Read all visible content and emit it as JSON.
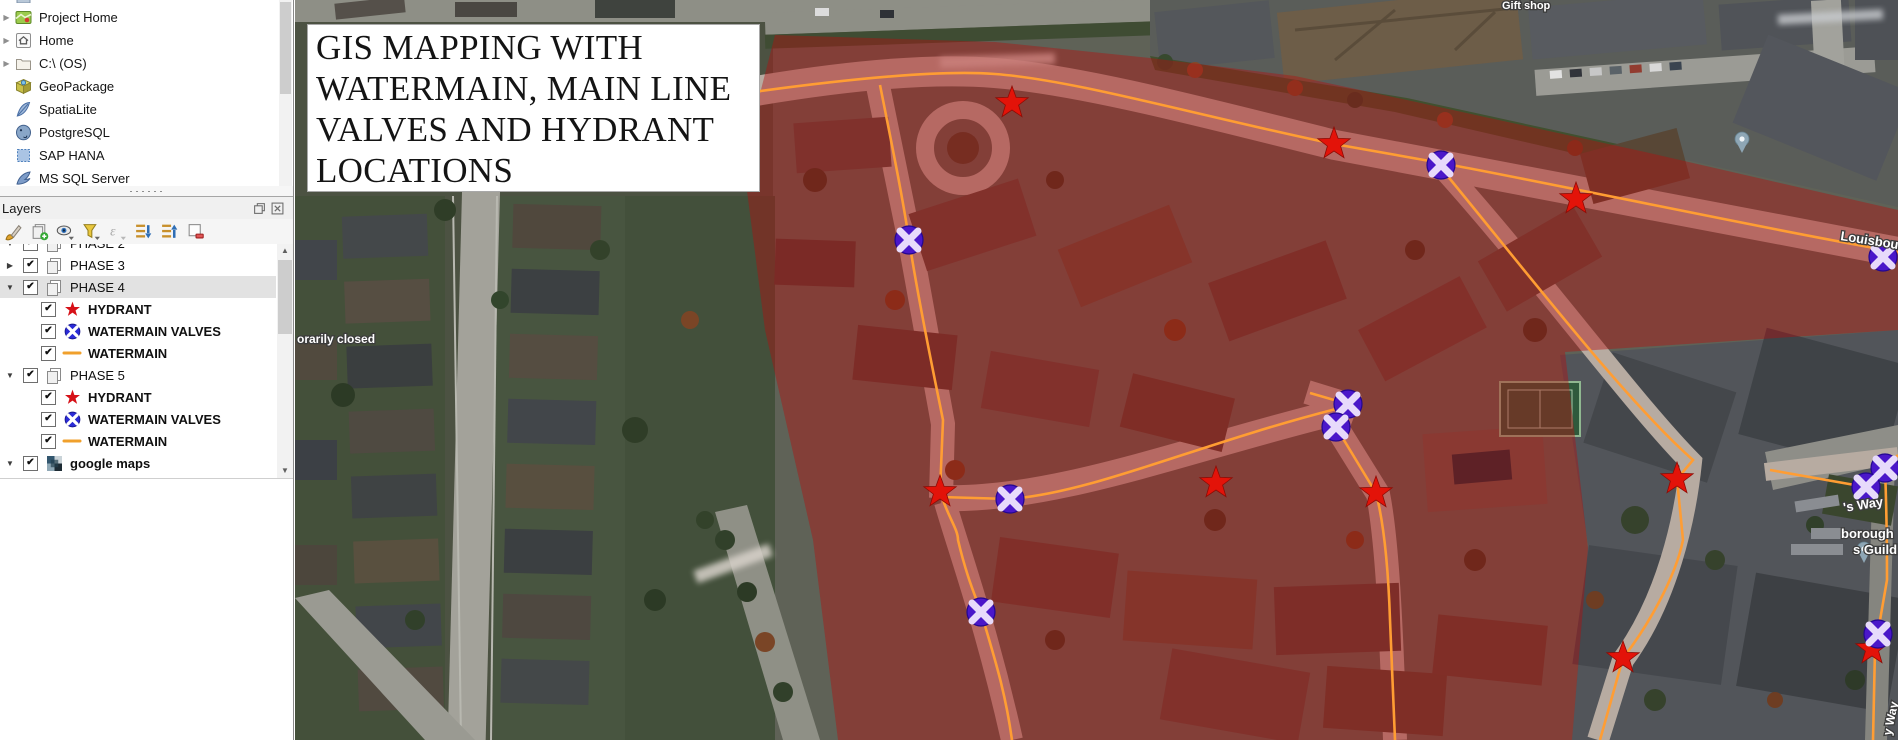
{
  "browser_panel": {
    "items": [
      {
        "label": "",
        "icon": "clipped-item",
        "partial": "top",
        "expand": false
      },
      {
        "label": "Project Home",
        "icon": "project-home",
        "expand": true
      },
      {
        "label": "Home",
        "icon": "home",
        "expand": true
      },
      {
        "label": "C:\\ (OS)",
        "icon": "drive-folder",
        "expand": true
      },
      {
        "label": "GeoPackage",
        "icon": "geopackage",
        "expand": false
      },
      {
        "label": "SpatiaLite",
        "icon": "spatialite",
        "expand": false
      },
      {
        "label": "PostgreSQL",
        "icon": "postgresql",
        "expand": false
      },
      {
        "label": "SAP HANA",
        "icon": "sap-hana",
        "expand": false
      },
      {
        "label": "MS SQL Server",
        "icon": "ms-sql-server",
        "expand": false
      },
      {
        "label": "",
        "icon": "clipped-item-bottom",
        "partial": "bottom",
        "expand": false
      }
    ]
  },
  "layers_panel": {
    "title": "Layers",
    "window_buttons": [
      {
        "name": "float-panel"
      },
      {
        "name": "close-panel"
      }
    ],
    "toolbar": [
      {
        "name": "open-layer-styling"
      },
      {
        "name": "add-group"
      },
      {
        "name": "manage-map-themes"
      },
      {
        "name": "filter-legend"
      },
      {
        "name": "filter-by-expression"
      },
      {
        "name": "expand-all"
      },
      {
        "name": "collapse-all"
      },
      {
        "name": "remove-layer"
      }
    ],
    "tree": [
      {
        "label": "PHASE 2",
        "kind": "group",
        "checked": true,
        "expander": "open",
        "partial": "top"
      },
      {
        "label": "PHASE 3",
        "kind": "group",
        "checked": true,
        "expander": "closed"
      },
      {
        "label": "PHASE 4",
        "kind": "group",
        "checked": true,
        "expander": "open",
        "selected": true
      },
      {
        "label": "HYDRANT",
        "kind": "layer",
        "symbol": "hydrant-star",
        "checked": true
      },
      {
        "label": "WATERMAIN VALVES",
        "kind": "layer",
        "symbol": "watermain-valve",
        "checked": true
      },
      {
        "label": "WATERMAIN",
        "kind": "layer",
        "symbol": "watermain-line",
        "checked": true
      },
      {
        "label": "PHASE 5",
        "kind": "group",
        "checked": true,
        "expander": "open"
      },
      {
        "label": "HYDRANT",
        "kind": "layer",
        "symbol": "hydrant-star",
        "checked": true
      },
      {
        "label": "WATERMAIN VALVES",
        "kind": "layer",
        "symbol": "watermain-valve",
        "checked": true
      },
      {
        "label": "WATERMAIN",
        "kind": "layer",
        "symbol": "watermain-line",
        "checked": true
      },
      {
        "label": "google maps",
        "kind": "basemap",
        "symbol": "basemap-tiles",
        "checked": true,
        "expander": "open",
        "bold": true
      }
    ]
  },
  "map": {
    "overlay_title": "GIS MAPPING WITH\nWATERMAIN, MAIN LINE\nVALVES AND HYDRANT\nLOCATIONS",
    "colors": {
      "zone_overlay": "#b40f0f",
      "watermain_line": "#ff9d33",
      "hydrant": "#e31309",
      "valve_fill": "#4a17c9",
      "valve_cross": "#e7dafb"
    },
    "hydrants": [
      {
        "x": 717,
        "y": 103
      },
      {
        "x": 1039,
        "y": 144
      },
      {
        "x": 1281,
        "y": 199
      },
      {
        "x": 645,
        "y": 492
      },
      {
        "x": 921,
        "y": 483
      },
      {
        "x": 1081,
        "y": 493
      },
      {
        "x": 1382,
        "y": 479
      },
      {
        "x": 1328,
        "y": 658
      },
      {
        "x": 1577,
        "y": 649
      }
    ],
    "valves": [
      {
        "x": 614,
        "y": 240
      },
      {
        "x": 1146,
        "y": 165
      },
      {
        "x": 1588,
        "y": 257
      },
      {
        "x": 1053,
        "y": 404
      },
      {
        "x": 1041,
        "y": 427
      },
      {
        "x": 715,
        "y": 499
      },
      {
        "x": 686,
        "y": 612
      },
      {
        "x": 1590,
        "y": 468
      },
      {
        "x": 1571,
        "y": 487
      },
      {
        "x": 1583,
        "y": 634
      }
    ],
    "pins": [
      {
        "x": 1447,
        "y": 152
      },
      {
        "x": 1569,
        "y": 562
      }
    ],
    "street_labels": [
      {
        "text": "Gift shop",
        "x": 1207,
        "y": 9,
        "size": 11,
        "rot": 0
      },
      {
        "text": "Louisbourg",
        "x": 1545,
        "y": 240,
        "size": 13,
        "rot": 9
      },
      {
        "text": "'s Way",
        "x": 1549,
        "y": 512,
        "size": 13,
        "rot": -9
      },
      {
        "text": "borough",
        "x": 1546,
        "y": 538,
        "size": 13,
        "rot": 0
      },
      {
        "text": "s Guild",
        "x": 1558,
        "y": 554,
        "size": 13,
        "rot": 0
      },
      {
        "text": "orarily closed",
        "x": 2,
        "y": 343,
        "size": 12,
        "rot": 0
      },
      {
        "text": "y Way",
        "x": 1596,
        "y": 736,
        "size": 12,
        "rot": -78
      }
    ]
  }
}
